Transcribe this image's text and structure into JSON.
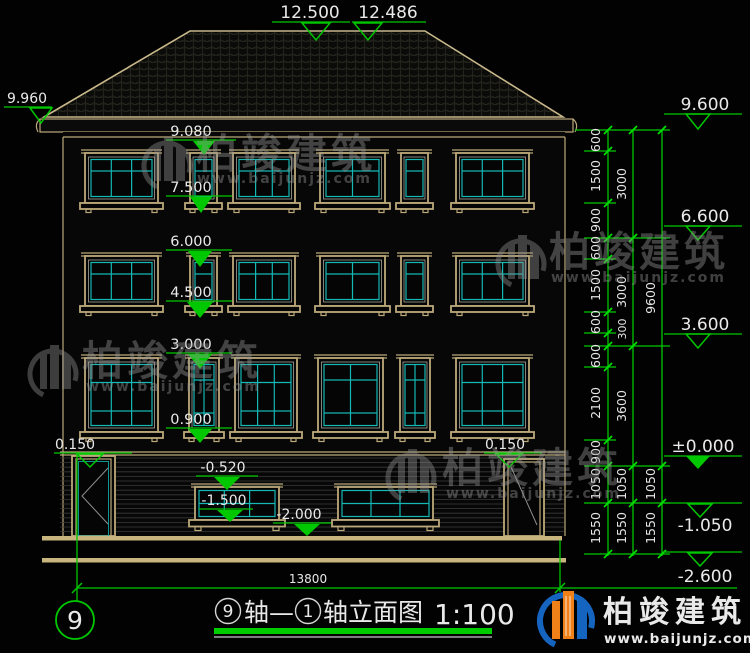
{
  "watermark": {
    "brand": "柏竣建筑",
    "url": "www.baijunjz.com"
  },
  "logo": {
    "brand": "柏竣建筑",
    "url": "www.baijunjz.com"
  },
  "footer": {
    "axis_bubble": "9",
    "dim_total": "13800",
    "title_axis_from": "9",
    "title_mid": "轴—",
    "title_axis_to": "1",
    "title_rest": "轴立面图",
    "title_scale": "1:100"
  },
  "markers": {
    "ridge_left": "12.500",
    "ridge_right": "12.486",
    "eave_left": "9.960",
    "center": [
      "9.080",
      "7.500",
      "6.000",
      "4.500",
      "3.000",
      "0.900"
    ],
    "entry_left": "0.150",
    "entry_right": "0.150",
    "base_lintel": "-0.520",
    "base_window": "-1.500",
    "base_ground": "-2.000",
    "right": [
      "9.600",
      "6.600",
      "3.600",
      "±0.000",
      "-1.050",
      "-2.600"
    ]
  },
  "dims": {
    "col1": [
      "600",
      "1500",
      "900",
      "600",
      "1500",
      "600",
      "600",
      "2100",
      "900",
      "1050",
      "1550"
    ],
    "col2": [
      "3000",
      "3000",
      "300",
      "3600",
      "1050",
      "1550"
    ],
    "col3": [
      "9600",
      "1050",
      "1550"
    ]
  }
}
